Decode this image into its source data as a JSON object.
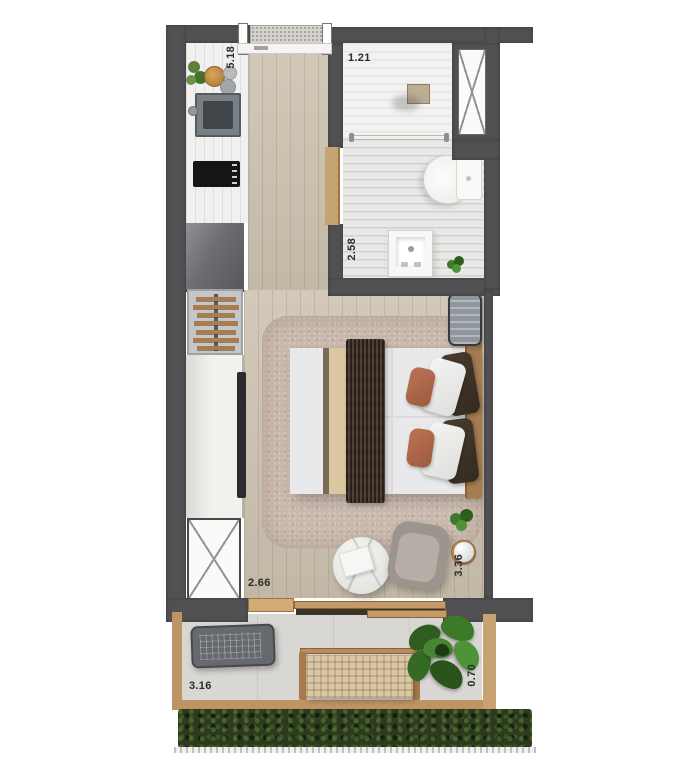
{
  "floor_plan": {
    "type": "studio-apartment-top-view-render",
    "dimension_labels": {
      "entry_side": "5.18",
      "bathroom_top": "1.21",
      "bathroom_side": "2.58",
      "bedroom_bottom": "2.66",
      "living_side": "3.36",
      "balcony_bottom": "3.16",
      "balcony_side": "0.70"
    },
    "colors": {
      "wall": "#515153",
      "wood_floor": "#cdc2b0",
      "bathroom_floor": "#e9e8e6",
      "rug": "#c9b9ad",
      "balcony_floor": "#d9d7d4",
      "hedge_green": "#2c3a1e",
      "wood_accent": "#bf9464",
      "blanket_brown": "#463931",
      "pillow_terracotta": "#b0694b",
      "label_text": "#2c2c2c"
    },
    "areas": [
      "kitchen",
      "bathroom",
      "bedroom-living",
      "balcony"
    ],
    "objects": [
      "kitchen-counter",
      "kitchen-sink",
      "cooktop",
      "fridge",
      "hanger-rack",
      "wardrobe",
      "utility-shaft",
      "doormat",
      "double-bed",
      "nightstand",
      "rug",
      "coffee-table",
      "armchair",
      "side-table-lamp",
      "toilet",
      "washbasin",
      "shower-glass",
      "ac-condenser",
      "bench",
      "potted-plants",
      "hedge",
      "railing"
    ]
  }
}
